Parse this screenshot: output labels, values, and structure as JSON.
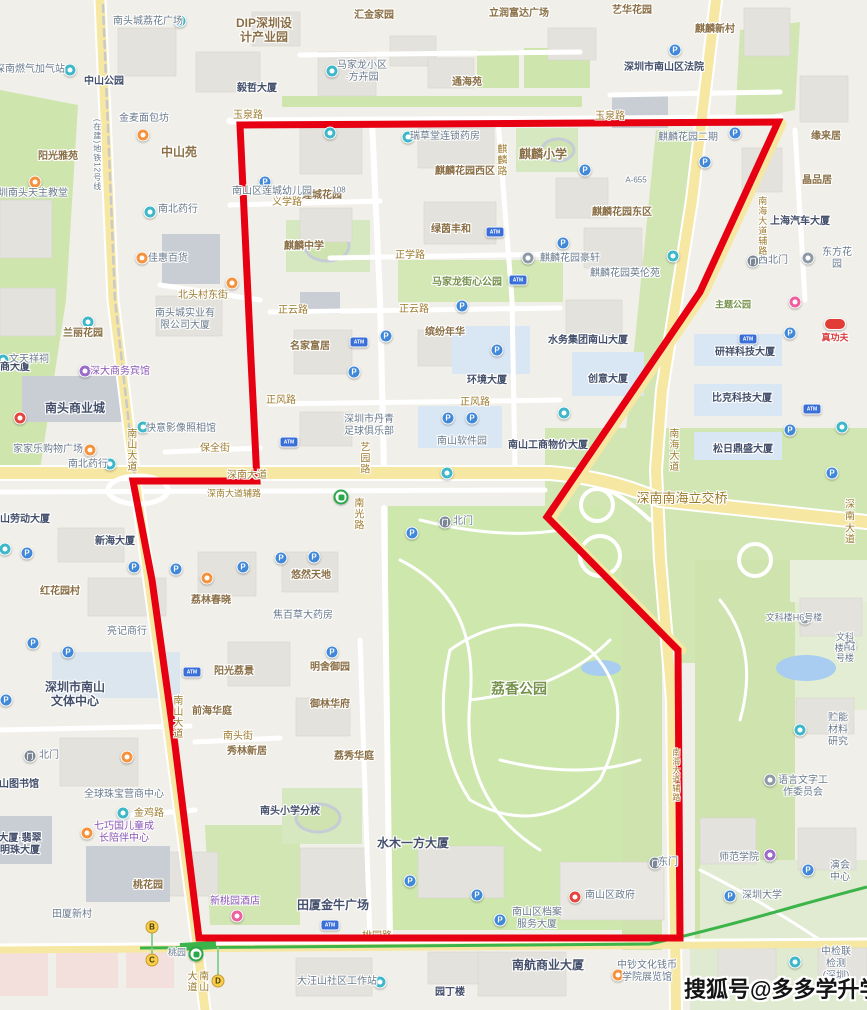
{
  "watermark": {
    "text": "搜狐号@多多学升学"
  },
  "map": {
    "colors": {
      "boundary": "#e60012",
      "metro_line": "#3cb44a",
      "major_road": "#f6e7a3",
      "park": "#cfe5ae",
      "water": "#a8cdf0"
    },
    "boundary": [
      [
        240,
        125
      ],
      [
        778,
        122
      ],
      [
        700,
        292
      ],
      [
        547,
        517
      ],
      [
        678,
        650
      ],
      [
        680,
        938
      ],
      [
        199,
        938
      ],
      [
        175,
        745
      ],
      [
        152,
        580
      ],
      [
        133,
        481
      ],
      [
        257,
        481
      ],
      [
        251,
        360
      ],
      [
        240,
        125
      ]
    ],
    "labels": [
      {
        "t": "南头城荔花广场",
        "x": 148,
        "y": 22,
        "c": "p"
      },
      {
        "t": "DIP深圳设\n计产业园",
        "x": 264,
        "y": 30,
        "c": "a",
        "s": 12
      },
      {
        "t": "汇金家园",
        "x": 374,
        "y": 16,
        "c": "a"
      },
      {
        "t": "立润富达广场",
        "x": 519,
        "y": 14,
        "c": "a"
      },
      {
        "t": "艺华花园",
        "x": 632,
        "y": 11,
        "c": "a"
      },
      {
        "t": "麒麟新村",
        "x": 715,
        "y": 30,
        "c": "a"
      },
      {
        "t": "深圳市南山区法院",
        "x": 664,
        "y": 68,
        "c": "b"
      },
      {
        "t": "马家龙小区\n·方卉园",
        "x": 362,
        "y": 72,
        "c": "p"
      },
      {
        "t": "通海苑",
        "x": 467,
        "y": 83,
        "c": "a"
      },
      {
        "t": "毅哲大厦",
        "x": 257,
        "y": 89,
        "c": "b"
      },
      {
        "t": "深南燃气加气站",
        "x": 30,
        "y": 70,
        "c": "p"
      },
      {
        "t": "中山公园",
        "x": 104,
        "y": 82,
        "c": "b"
      },
      {
        "t": "玉泉路",
        "x": 248,
        "y": 116,
        "c": "r"
      },
      {
        "t": "玉泉路",
        "x": 610,
        "y": 117,
        "c": "r"
      },
      {
        "t": "中山苑",
        "x": 179,
        "y": 152,
        "c": "a",
        "s": 12
      },
      {
        "t": "阳光雅苑",
        "x": 58,
        "y": 157,
        "c": "a"
      },
      {
        "t": "金麦面包坊",
        "x": 144,
        "y": 119,
        "c": "p"
      },
      {
        "t": "缘来居",
        "x": 826,
        "y": 137,
        "c": "a"
      },
      {
        "t": "晶品居",
        "x": 817,
        "y": 181,
        "c": "a"
      },
      {
        "t": "上海汽车大厦",
        "x": 800,
        "y": 222,
        "c": "b"
      },
      {
        "t": "麒麟花园二期",
        "x": 688,
        "y": 138,
        "c": "p"
      },
      {
        "t": "麒麟小学",
        "x": 543,
        "y": 154,
        "c": "a",
        "s": 12
      },
      {
        "t": "麒麟花园西区",
        "x": 465,
        "y": 172,
        "c": "a"
      },
      {
        "t": "莲城花园",
        "x": 322,
        "y": 196,
        "c": "a"
      },
      {
        "t": "瑞草堂连锁药房",
        "x": 445,
        "y": 137,
        "c": "p"
      },
      {
        "t": "南山区莲城幼儿园",
        "x": 272,
        "y": 192,
        "c": "p"
      },
      {
        "t": "义学路",
        "x": 287,
        "y": 203,
        "c": "r"
      },
      {
        "t": "麒麟花园东区",
        "x": 622,
        "y": 213,
        "c": "a"
      },
      {
        "t": "麒麟中学",
        "x": 304,
        "y": 247,
        "c": "a"
      },
      {
        "t": "绿茵丰和",
        "x": 451,
        "y": 230,
        "c": "a"
      },
      {
        "t": "南北药行",
        "x": 178,
        "y": 210,
        "c": "p"
      },
      {
        "t": "正学路",
        "x": 410,
        "y": 256,
        "c": "r"
      },
      {
        "t": "马家龙街心公园",
        "x": 467,
        "y": 283,
        "c": "g"
      },
      {
        "t": "麒麟花园豪轩",
        "x": 570,
        "y": 259,
        "c": "p"
      },
      {
        "t": "麒麟花园英伦苑",
        "x": 625,
        "y": 274,
        "c": "p"
      },
      {
        "t": "正云路",
        "x": 293,
        "y": 311,
        "c": "r"
      },
      {
        "t": "正云路",
        "x": 414,
        "y": 310,
        "c": "r"
      },
      {
        "t": "北头村东街",
        "x": 203,
        "y": 296,
        "c": "r"
      },
      {
        "t": "南头城实业有\n限公司大厦",
        "x": 185,
        "y": 320,
        "c": "p"
      },
      {
        "t": "兰丽花园",
        "x": 83,
        "y": 334,
        "c": "a"
      },
      {
        "t": "名家富居",
        "x": 310,
        "y": 347,
        "c": "a"
      },
      {
        "t": "缤纷年华",
        "x": 445,
        "y": 333,
        "c": "a"
      },
      {
        "t": "水务集团南山大厦",
        "x": 588,
        "y": 341,
        "c": "b"
      },
      {
        "t": "久商大厦",
        "x": 10,
        "y": 368,
        "c": "b"
      },
      {
        "t": "深大商务宾馆",
        "x": 120,
        "y": 372,
        "c": "pu"
      },
      {
        "t": "南头商业城",
        "x": 75,
        "y": 408,
        "c": "b",
        "s": 12
      },
      {
        "t": "文天祥祠",
        "x": 29,
        "y": 360,
        "c": "p"
      },
      {
        "t": "佳惠百货",
        "x": 168,
        "y": 259,
        "c": "p"
      },
      {
        "t": "深圳南头天主教堂",
        "x": 28,
        "y": 194,
        "c": "p"
      },
      {
        "t": "环境大厦",
        "x": 487,
        "y": 381,
        "c": "b"
      },
      {
        "t": "创意大厦",
        "x": 608,
        "y": 380,
        "c": "b"
      },
      {
        "t": "研祥科技大厦",
        "x": 745,
        "y": 353,
        "c": "b"
      },
      {
        "t": "比克科技大厦",
        "x": 742,
        "y": 399,
        "c": "b"
      },
      {
        "t": "松日鼎盛大厦",
        "x": 743,
        "y": 450,
        "c": "b"
      },
      {
        "t": "真功夫",
        "x": 835,
        "y": 338,
        "c": "rd",
        "s": 9
      },
      {
        "t": "主题公园",
        "x": 733,
        "y": 305,
        "c": "g",
        "s": 9
      },
      {
        "t": "东方花园",
        "x": 837,
        "y": 259,
        "c": "p"
      },
      {
        "t": "西北门",
        "x": 773,
        "y": 261,
        "c": "p"
      },
      {
        "t": "正风路",
        "x": 281,
        "y": 401,
        "c": "r"
      },
      {
        "t": "正风路",
        "x": 475,
        "y": 403,
        "c": "r"
      },
      {
        "t": "深圳市丹青\n足球俱乐部",
        "x": 369,
        "y": 426,
        "c": "p"
      },
      {
        "t": "南山软件园",
        "x": 462,
        "y": 442,
        "c": "p"
      },
      {
        "t": "南山工商物价大厦",
        "x": 548,
        "y": 446,
        "c": "b"
      },
      {
        "t": "快意影像照相馆",
        "x": 181,
        "y": 429,
        "c": "p"
      },
      {
        "t": "南北药行",
        "x": 88,
        "y": 465,
        "c": "p"
      },
      {
        "t": "保全街",
        "x": 215,
        "y": 449,
        "c": "r"
      },
      {
        "t": "家家乐购物广场",
        "x": 48,
        "y": 450,
        "c": "p"
      },
      {
        "t": "南山大道",
        "x": 130,
        "y": 450,
        "c": "r",
        "v": 1
      },
      {
        "t": "艺园路",
        "x": 363,
        "y": 458,
        "c": "r",
        "v": 1
      },
      {
        "t": "深南大道",
        "x": 247,
        "y": 476,
        "c": "r"
      },
      {
        "t": "深南大道辅路",
        "x": 234,
        "y": 494,
        "c": "r",
        "s": 9
      },
      {
        "t": "深南大道",
        "x": 850,
        "y": 523,
        "c": "r"
      },
      {
        "t": "深南南海立交桥",
        "x": 682,
        "y": 498,
        "c": "r",
        "s": 13
      },
      {
        "t": "南海大道",
        "x": 672,
        "y": 450,
        "c": "r",
        "v": 1
      },
      {
        "t": "南海大道辅路",
        "x": 762,
        "y": 226,
        "c": "r",
        "v": 1,
        "s": 9
      },
      {
        "t": "南海大道辅路",
        "x": 676,
        "y": 775,
        "c": "r",
        "v": 1,
        "s": 8
      },
      {
        "t": "南山劳动大厦",
        "x": 20,
        "y": 520,
        "c": "b"
      },
      {
        "t": "新海大厦",
        "x": 115,
        "y": 542,
        "c": "b"
      },
      {
        "t": "红花园村",
        "x": 60,
        "y": 592,
        "c": "a"
      },
      {
        "t": "荔林春晓",
        "x": 211,
        "y": 601,
        "c": "a"
      },
      {
        "t": "悠然天地",
        "x": 311,
        "y": 576,
        "c": "a"
      },
      {
        "t": "亮记商行",
        "x": 127,
        "y": 632,
        "c": "p"
      },
      {
        "t": "焦百草大药房",
        "x": 303,
        "y": 616,
        "c": "p"
      },
      {
        "t": "北门",
        "x": 463,
        "y": 522,
        "c": "p"
      },
      {
        "t": "南光路",
        "x": 357,
        "y": 514,
        "c": "r",
        "v": 1
      },
      {
        "t": "荔香公园",
        "x": 519,
        "y": 689,
        "c": "g",
        "s": 14
      },
      {
        "t": "深圳市南山\n文体中心",
        "x": 75,
        "y": 694,
        "c": "b",
        "s": 12
      },
      {
        "t": "阳光荔景",
        "x": 234,
        "y": 672,
        "c": "a"
      },
      {
        "t": "前海华庭",
        "x": 212,
        "y": 712,
        "c": "a"
      },
      {
        "t": "南头街",
        "x": 238,
        "y": 737,
        "c": "r"
      },
      {
        "t": "秀林新居",
        "x": 247,
        "y": 752,
        "c": "a"
      },
      {
        "t": "南山大道",
        "x": 176,
        "y": 717,
        "c": "r",
        "v": 1
      },
      {
        "t": "明舍御园",
        "x": 330,
        "y": 668,
        "c": "a"
      },
      {
        "t": "御林华府",
        "x": 330,
        "y": 705,
        "c": "a"
      },
      {
        "t": "荔秀华庭",
        "x": 354,
        "y": 757,
        "c": "a"
      },
      {
        "t": "北门",
        "x": 49,
        "y": 756,
        "c": "p"
      },
      {
        "t": "南山图书馆",
        "x": 14,
        "y": 785,
        "c": "b"
      },
      {
        "t": "全球珠宝营商中心",
        "x": 124,
        "y": 795,
        "c": "p"
      },
      {
        "t": "金鸡路",
        "x": 149,
        "y": 814,
        "c": "r"
      },
      {
        "t": "南头小学分校",
        "x": 290,
        "y": 812,
        "c": "b"
      },
      {
        "t": "桃花园",
        "x": 148,
        "y": 886,
        "c": "a"
      },
      {
        "t": "七巧国儿童成\n长陪伴中心",
        "x": 124,
        "y": 833,
        "c": "pu"
      },
      {
        "t": "大厦·翡翠\n明珠大厦",
        "x": 20,
        "y": 845,
        "c": "b"
      },
      {
        "t": "田厦新村",
        "x": 72,
        "y": 915,
        "c": "p"
      },
      {
        "t": "新桃园酒店",
        "x": 235,
        "y": 902,
        "c": "pu"
      },
      {
        "t": "田厦金牛广场",
        "x": 333,
        "y": 905,
        "c": "b",
        "s": 12
      },
      {
        "t": "水木一方大厦",
        "x": 413,
        "y": 843,
        "c": "b",
        "s": 12
      },
      {
        "t": "南山区档案\n服务大厦",
        "x": 537,
        "y": 919,
        "c": "p"
      },
      {
        "t": "南山区政府",
        "x": 610,
        "y": 896,
        "c": "p"
      },
      {
        "t": "东门",
        "x": 668,
        "y": 863,
        "c": "p"
      },
      {
        "t": "桃园路",
        "x": 377,
        "y": 937,
        "c": "r",
        "u": 1
      },
      {
        "t": "桃园",
        "x": 177,
        "y": 953,
        "c": "p",
        "s": 9
      },
      {
        "t": "南山大道",
        "x": 196,
        "y": 981,
        "c": "r",
        "v": 1
      },
      {
        "t": "南航商业大厦",
        "x": 548,
        "y": 965,
        "c": "b",
        "s": 12
      },
      {
        "t": "大汪山社区工作站",
        "x": 337,
        "y": 982,
        "c": "p"
      },
      {
        "t": "园丁楼",
        "x": 450,
        "y": 993,
        "c": "b"
      },
      {
        "t": "中钞文化钱币\n学院展览馆",
        "x": 647,
        "y": 972,
        "c": "p"
      },
      {
        "t": "中检联检测\n(深圳)基地",
        "x": 836,
        "y": 970,
        "c": "p"
      },
      {
        "t": "师范学院",
        "x": 739,
        "y": 858,
        "c": "p"
      },
      {
        "t": "深圳大学",
        "x": 762,
        "y": 896,
        "c": "p"
      },
      {
        "t": "演会中心",
        "x": 840,
        "y": 872,
        "c": "p"
      },
      {
        "t": "贮能材料研究",
        "x": 838,
        "y": 730,
        "c": "p"
      },
      {
        "t": "语言文字工\n作委员会",
        "x": 803,
        "y": 787,
        "c": "p"
      },
      {
        "t": "文科楼H6号楼",
        "x": 794,
        "y": 618,
        "c": "p",
        "s": 9
      },
      {
        "t": "文科楼H4号楼",
        "x": 845,
        "y": 648,
        "c": "p",
        "s": 9
      },
      {
        "t": "麒麟路",
        "x": 500,
        "y": 160,
        "c": "r",
        "v": 1
      },
      {
        "t": "A-655",
        "x": 636,
        "y": 180,
        "c": "p",
        "s": 8
      },
      {
        "t": "108",
        "x": 339,
        "y": 190,
        "c": "p",
        "s": 8
      },
      {
        "t": "(在建)地铁12号线",
        "x": 97,
        "y": 155,
        "c": "p",
        "v": 1,
        "s": 8
      }
    ],
    "pois": [
      {
        "x": 180,
        "y": 21,
        "k": "teal"
      },
      {
        "x": 70,
        "y": 70,
        "k": "teal"
      },
      {
        "x": 332,
        "y": 71,
        "k": "teal"
      },
      {
        "x": 150,
        "y": 212,
        "k": "teal"
      },
      {
        "x": 408,
        "y": 137,
        "k": "teal"
      },
      {
        "x": 88,
        "y": 322,
        "k": "teal"
      },
      {
        "x": 3,
        "y": 360,
        "k": "teal"
      },
      {
        "x": 143,
        "y": 427,
        "k": "teal"
      },
      {
        "x": 110,
        "y": 464,
        "k": "teal"
      },
      {
        "x": 5,
        "y": 549,
        "k": "teal"
      },
      {
        "x": 123,
        "y": 813,
        "k": "teal"
      },
      {
        "x": 380,
        "y": 982,
        "k": "teal"
      },
      {
        "x": 795,
        "y": 962,
        "k": "teal"
      },
      {
        "x": 800,
        "y": 730,
        "k": "teal"
      },
      {
        "x": 564,
        "y": 413,
        "k": "teal"
      },
      {
        "x": 842,
        "y": 427,
        "k": "teal"
      },
      {
        "x": 673,
        "y": 256,
        "k": "teal"
      },
      {
        "x": 330,
        "y": 133,
        "k": "teal"
      },
      {
        "x": 447,
        "y": 473,
        "k": "teal"
      },
      {
        "x": 675,
        "y": 50,
        "k": "blue"
      },
      {
        "x": 735,
        "y": 133,
        "k": "blue"
      },
      {
        "x": 705,
        "y": 162,
        "k": "blue"
      },
      {
        "x": 585,
        "y": 170,
        "k": "blue"
      },
      {
        "x": 563,
        "y": 243,
        "k": "blue"
      },
      {
        "x": 265,
        "y": 182,
        "k": "blue"
      },
      {
        "x": 386,
        "y": 336,
        "k": "blue"
      },
      {
        "x": 354,
        "y": 372,
        "k": "blue"
      },
      {
        "x": 462,
        "y": 306,
        "k": "blue"
      },
      {
        "x": 497,
        "y": 350,
        "k": "blue"
      },
      {
        "x": 448,
        "y": 418,
        "k": "blue"
      },
      {
        "x": 472,
        "y": 418,
        "k": "blue"
      },
      {
        "x": 790,
        "y": 333,
        "k": "blue"
      },
      {
        "x": 790,
        "y": 430,
        "k": "blue"
      },
      {
        "x": 832,
        "y": 473,
        "k": "blue"
      },
      {
        "x": 134,
        "y": 567,
        "k": "blue"
      },
      {
        "x": 176,
        "y": 569,
        "k": "blue"
      },
      {
        "x": 243,
        "y": 567,
        "k": "blue"
      },
      {
        "x": 281,
        "y": 558,
        "k": "blue"
      },
      {
        "x": 27,
        "y": 553,
        "k": "blue"
      },
      {
        "x": 412,
        "y": 533,
        "k": "blue"
      },
      {
        "x": 314,
        "y": 557,
        "k": "blue"
      },
      {
        "x": 33,
        "y": 643,
        "k": "blue"
      },
      {
        "x": 68,
        "y": 652,
        "k": "blue"
      },
      {
        "x": 6,
        "y": 700,
        "k": "blue"
      },
      {
        "x": 332,
        "y": 652,
        "k": "blue"
      },
      {
        "x": 410,
        "y": 881,
        "k": "blue"
      },
      {
        "x": 477,
        "y": 895,
        "k": "blue"
      },
      {
        "x": 500,
        "y": 920,
        "k": "blue"
      },
      {
        "x": 730,
        "y": 896,
        "k": "blue"
      },
      {
        "x": 808,
        "y": 870,
        "k": "blue"
      },
      {
        "x": 143,
        "y": 135,
        "k": "orange"
      },
      {
        "x": 35,
        "y": 182,
        "k": "orange"
      },
      {
        "x": 142,
        "y": 258,
        "k": "orange"
      },
      {
        "x": 232,
        "y": 283,
        "k": "orange"
      },
      {
        "x": 90,
        "y": 450,
        "k": "orange"
      },
      {
        "x": 207,
        "y": 578,
        "k": "orange"
      },
      {
        "x": 127,
        "y": 757,
        "k": "orange"
      },
      {
        "x": 87,
        "y": 833,
        "k": "orange"
      },
      {
        "x": 618,
        "y": 975,
        "k": "orange"
      },
      {
        "x": 237,
        "y": 916,
        "k": "pink"
      },
      {
        "x": 795,
        "y": 302,
        "k": "pink"
      },
      {
        "x": 85,
        "y": 371,
        "k": "purple"
      },
      {
        "x": 770,
        "y": 855,
        "k": "purple"
      },
      {
        "x": 20,
        "y": 418,
        "k": "red"
      },
      {
        "x": 575,
        "y": 897,
        "k": "red"
      },
      {
        "x": 528,
        "y": 258,
        "k": "gray"
      },
      {
        "x": 808,
        "y": 258,
        "k": "gray"
      },
      {
        "x": 770,
        "y": 780,
        "k": "gray"
      },
      {
        "x": 805,
        "y": 618,
        "k": "gray"
      },
      {
        "x": 850,
        "y": 645,
        "k": "gray"
      },
      {
        "x": 445,
        "y": 522,
        "k": "gate"
      },
      {
        "x": 30,
        "y": 756,
        "k": "gate"
      },
      {
        "x": 753,
        "y": 261,
        "k": "gate"
      },
      {
        "x": 655,
        "y": 863,
        "k": "gate"
      },
      {
        "x": 495,
        "y": 232,
        "k": "atm"
      },
      {
        "x": 518,
        "y": 280,
        "k": "atm"
      },
      {
        "x": 359,
        "y": 342,
        "k": "atm"
      },
      {
        "x": 289,
        "y": 442,
        "k": "atm"
      },
      {
        "x": 748,
        "y": 339,
        "k": "atm"
      },
      {
        "x": 812,
        "y": 409,
        "k": "atm"
      },
      {
        "x": 192,
        "y": 672,
        "k": "atm"
      },
      {
        "x": 330,
        "y": 925,
        "k": "atm"
      },
      {
        "x": 341,
        "y": 497,
        "k": "metro"
      },
      {
        "x": 196,
        "y": 954,
        "k": "metro"
      },
      {
        "x": 835,
        "y": 324,
        "k": "brand"
      }
    ],
    "bus_stops": [
      {
        "letter": "B",
        "x": 152,
        "y": 927
      },
      {
        "letter": "C",
        "x": 152,
        "y": 960
      },
      {
        "letter": "D",
        "x": 218,
        "y": 981
      }
    ]
  }
}
